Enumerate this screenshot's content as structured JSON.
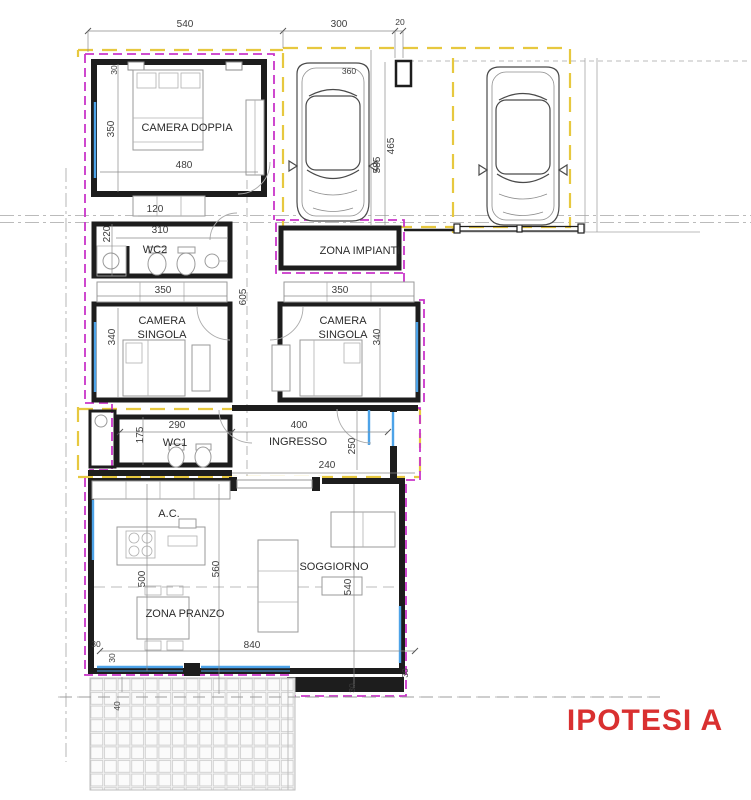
{
  "title": {
    "text": "IPOTESI A"
  },
  "colors": {
    "title_red": "#d93030",
    "boundary_magenta": "#c935c9",
    "boundary_yellow": "#e7c83f",
    "window_blue": "#4da3e8",
    "wall_black": "#1d1d1d"
  },
  "rooms": {
    "camera_doppia": "CAMERA DOPPIA",
    "camera_singola_line1": "CAMERA",
    "camera_singola_line2": "SINGOLA",
    "wc2": "WC2",
    "wc1": "WC1",
    "zona_impianti": "ZONA IMPIANTI",
    "ingresso": "INGRESSO",
    "soggiorno": "SOGGIORNO",
    "zona_pranzo": "ZONA PRANZO",
    "ac": "A.C."
  },
  "dims": {
    "top_width": "540",
    "top_bay": "300",
    "top_pillar": "20",
    "carport_bay": "360",
    "wall_30": "30",
    "cd_height": "350",
    "cd_width": "480",
    "closet_120": "120",
    "wc2_height": "220",
    "wc2_width": "310",
    "singola_width": "350",
    "corridor_605": "605",
    "singola_height": "340",
    "carport_585": "585",
    "carport_465": "465",
    "wc1_width": "290",
    "wc1_height": "175",
    "ingresso_width": "400",
    "ingresso_250": "250",
    "opening_240": "240",
    "living_500": "500",
    "living_560": "560",
    "soggiorno_540": "540",
    "living_840": "840",
    "patio_40": "40"
  }
}
